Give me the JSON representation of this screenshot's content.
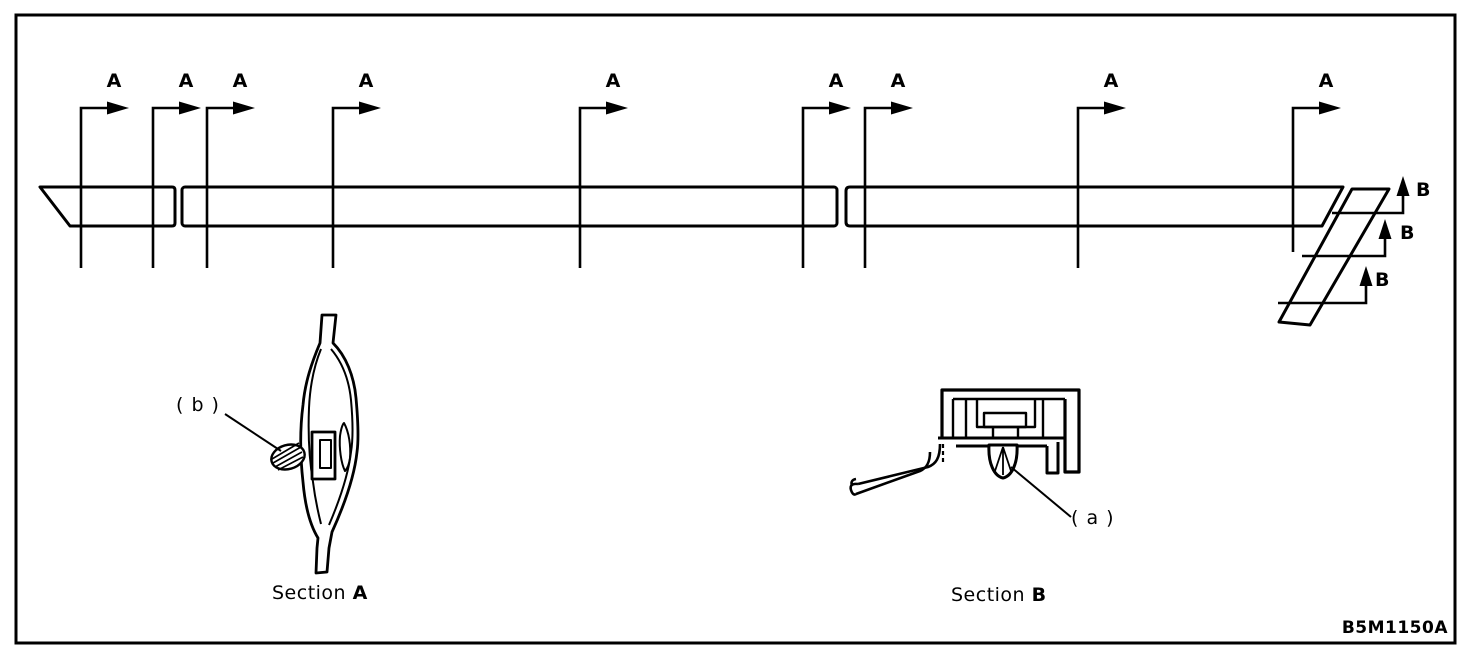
{
  "figure": {
    "part_code": "B5M1150A",
    "cut_marker_a": "A",
    "cut_marker_b": "B",
    "section_a": {
      "caption_prefix": "Section",
      "caption_letter": "A",
      "clip_callout": "( b )"
    },
    "section_b": {
      "caption_prefix": "Section",
      "caption_letter": "B",
      "clip_callout": "( a )"
    },
    "colors": {
      "line_color": "#000000",
      "background": "#ffffff"
    }
  }
}
